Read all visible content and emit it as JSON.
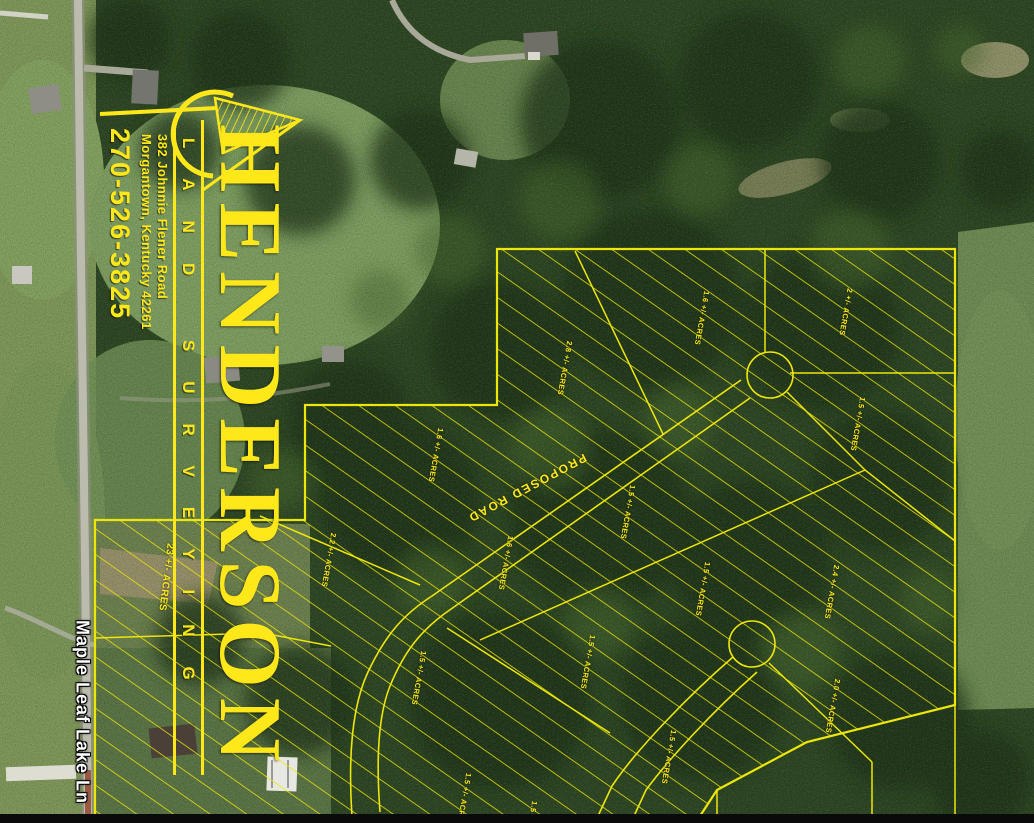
{
  "page": {
    "type": "aerial-survey-plat",
    "width": 1034,
    "height": 823
  },
  "logo": {
    "company": "HENDERSON",
    "tagline": "LAND SURVEYING",
    "address_line1": "382 Johnnie Flener Road",
    "address_line2": "Morgantown, Kentucky 42261",
    "phone": "270-526-3825",
    "color": "#ffe81a",
    "swoosh_icon": "hatched-flag-arc"
  },
  "map": {
    "street_label": "Maple Leaf Lake Ln",
    "proposed_road_label": "PROPOSED ROAD",
    "survey_line_color": "#ede60a",
    "lot_label_color": "#ffe91c",
    "street_label_color": "#ffffff",
    "cul_de_sac_count": 2,
    "lots": [
      {
        "label": "2.8 +/- ACRES",
        "x": 565,
        "y": 368,
        "rot": 100
      },
      {
        "label": "1.6 +/- ACRES",
        "x": 702,
        "y": 318,
        "rot": 100
      },
      {
        "label": "2 +/- ACRES",
        "x": 846,
        "y": 312,
        "rot": 100
      },
      {
        "label": "1.5 +/- ACRES",
        "x": 858,
        "y": 424,
        "rot": 100
      },
      {
        "label": "1.6 +/- ACRES",
        "x": 436,
        "y": 455,
        "rot": 100
      },
      {
        "label": "2.2 +/- ACRES",
        "x": 329,
        "y": 560,
        "rot": 100
      },
      {
        "label": "1.6 +/- ACRES",
        "x": 506,
        "y": 563,
        "rot": 100
      },
      {
        "label": "1.5 +/- ACRES",
        "x": 628,
        "y": 512,
        "rot": 100
      },
      {
        "label": "23 +/- ACRES",
        "x": 166,
        "y": 577,
        "rot": 97,
        "size": 10
      },
      {
        "label": "1.5 +/- ACRES",
        "x": 419,
        "y": 678,
        "rot": 100
      },
      {
        "label": "1.5 +/- ACRES",
        "x": 588,
        "y": 662,
        "rot": 100
      },
      {
        "label": "1.5 +/- ACRES",
        "x": 703,
        "y": 589,
        "rot": 100
      },
      {
        "label": "2.4 +/- ACRES",
        "x": 832,
        "y": 592,
        "rot": 100
      },
      {
        "label": "2.0 +/- ACRES",
        "x": 833,
        "y": 706,
        "rot": 100
      },
      {
        "label": "1.5 +/- ACRES",
        "x": 669,
        "y": 757,
        "rot": 100
      },
      {
        "label": "1.5 +/- ACRES",
        "x": 464,
        "y": 800,
        "rot": 100
      },
      {
        "label": "1.5 +/- ACRES",
        "x": 530,
        "y": 828,
        "rot": 100
      }
    ]
  }
}
